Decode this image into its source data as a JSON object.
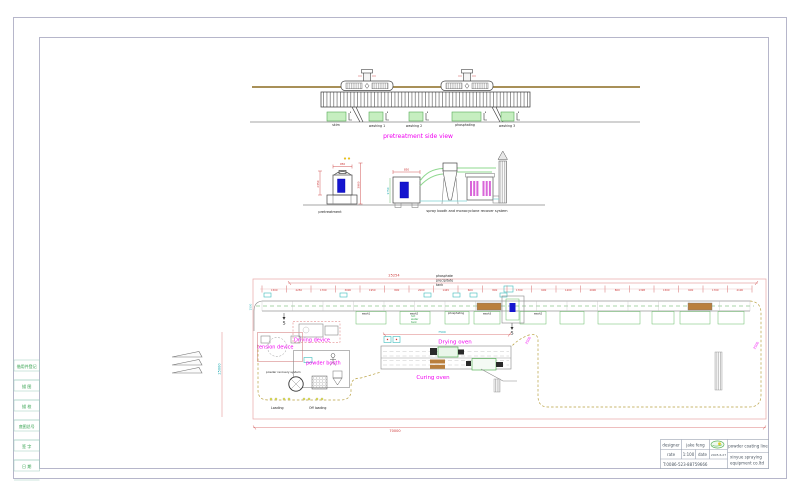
{
  "colors": {
    "magenta": "#f000f0",
    "dim_red": "#cc3333",
    "frame_gray": "#b6b6ca",
    "pink_dim": "#e8a8a8",
    "green": "#2fa04a",
    "cyan": "#16a8b0",
    "olive_conveyor": "#b8a040",
    "brown_rail": "#9c8040",
    "tank_green_fill": "#c6eec0",
    "blue_fill": "#1515cf",
    "tan_fill": "#b97f3c"
  },
  "frame": {
    "sidebar_cells": [
      "借用件登记",
      "描 图",
      "描 校",
      "底图总号",
      "签 字",
      "日 期"
    ]
  },
  "title_block": {
    "designer_label": "designer",
    "designer": "jake feng",
    "rate_label": "rate",
    "rate": "1:100",
    "date_label": "date",
    "date": "2005.6.27",
    "phone": "T:0086-523-88759666",
    "project": "powder coating line",
    "company_line1": "xinyue spraying",
    "company_line2": "equipment co.ltd",
    "logo": "xinyue-logo"
  },
  "side_view": {
    "title": "pretreatment side view",
    "tanks": [
      "skim",
      "washing 1",
      "washing 2",
      "phosphating",
      "washing 3"
    ]
  },
  "sections": {
    "left_label": "pretreatment",
    "right_label": "spray booth and monocyclone recover system"
  },
  "section_dims": {
    "left_w": "950",
    "left_h1": "2350",
    "left_h2": "3960",
    "booth_w": "850",
    "booth_h": "1750"
  },
  "plan": {
    "top_dim": "25254",
    "bottom_dim": "70000",
    "left_dim": "25000",
    "conveyor_dim": "1500",
    "oven_dim": "7500",
    "right_dim_1": "2500",
    "right_dim_2": "2500",
    "section_mark": "S",
    "phosphate_tank": [
      "phosphate",
      "precipitate",
      "tank"
    ],
    "hot_water_tank": [
      "hot",
      "water",
      "tank"
    ],
    "row_labels": [
      "wash1",
      "wash2",
      "phosphating",
      "wash3",
      "wash2"
    ],
    "labels": {
      "tension": "tension device",
      "driving": "Driving device",
      "powder_booth": "powder booth",
      "powder_recovery": "powder recovery system",
      "loading": "Loading",
      "off_loading": "Off loading",
      "drying": "Drying oven",
      "curing": "Curing oven"
    },
    "tick_dims": [
      "1500",
      "2250",
      "1700",
      "3000",
      "1950",
      "800",
      "2000",
      "1445",
      "600",
      "800",
      "1700",
      "600",
      "1200",
      "2000",
      "800",
      "1398",
      "1500",
      "600",
      "1700",
      "2100"
    ]
  }
}
